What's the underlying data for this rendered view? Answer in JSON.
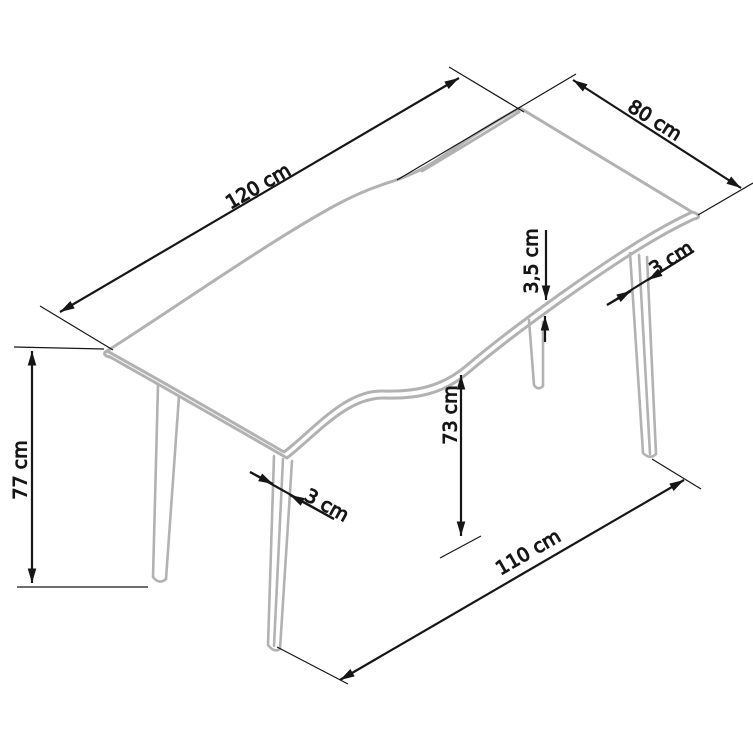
{
  "diagram_type": "furniture-dimension-drawing",
  "colors": {
    "background": "#ffffff",
    "table_outline": "#b2b2b2",
    "dimension_lines": "#161616"
  },
  "dimensions": {
    "tabletop_length": {
      "label": "120 cm"
    },
    "tabletop_width": {
      "label": "80 cm"
    },
    "tabletop_thickness": {
      "label": "3,5 cm"
    },
    "rear_leg_thickness": {
      "label": "3 cm"
    },
    "total_height": {
      "label": "77 cm"
    },
    "underside_height": {
      "label": "73 cm"
    },
    "front_leg_thickness": {
      "label": "3 cm"
    },
    "floor_span": {
      "label": "110 cm"
    }
  }
}
